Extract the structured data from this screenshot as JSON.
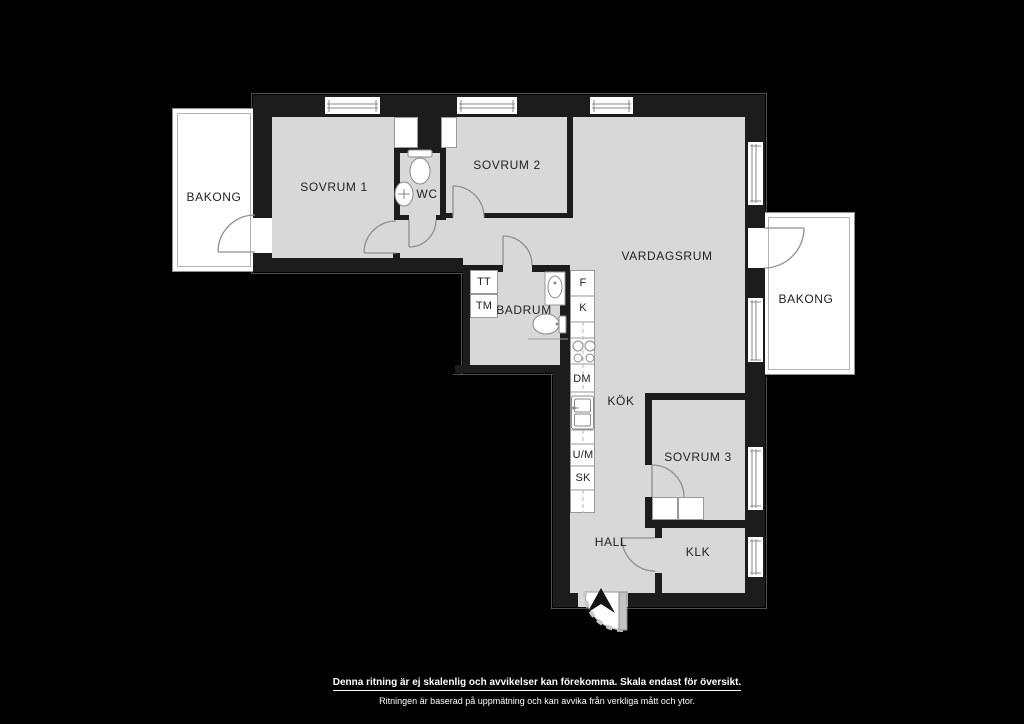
{
  "plan": {
    "rooms": {
      "bakong_left": "BAKONG",
      "sovrum1": "SOVRUM 1",
      "wc": "WC",
      "sovrum2": "SOVRUM 2",
      "vardagsrum": "VARDAGSRUM",
      "bakong_right": "BAKONG",
      "badrum": "BADRUM",
      "kok": "KÖK",
      "sovrum3": "SOVRUM 3",
      "hall": "HALL",
      "klk": "KLK"
    },
    "appliances": {
      "tt": "TT",
      "tm": "TM",
      "f": "F",
      "k": "K",
      "dm": "DM",
      "um": "U/M",
      "sk": "SK"
    },
    "footer": {
      "line1": "Denna ritning är ej skalenlig och avvikelser kan förekomma. Skala endast för översikt.",
      "line2": "Ritningen är baserad på uppmätning och kan avvika från verkliga mått och ytor."
    },
    "colors": {
      "background": "#000000",
      "floor": "#d8d8d8",
      "wall": "#1c1c1c",
      "fixture": "#ffffff",
      "line": "#8a8a8a"
    }
  }
}
